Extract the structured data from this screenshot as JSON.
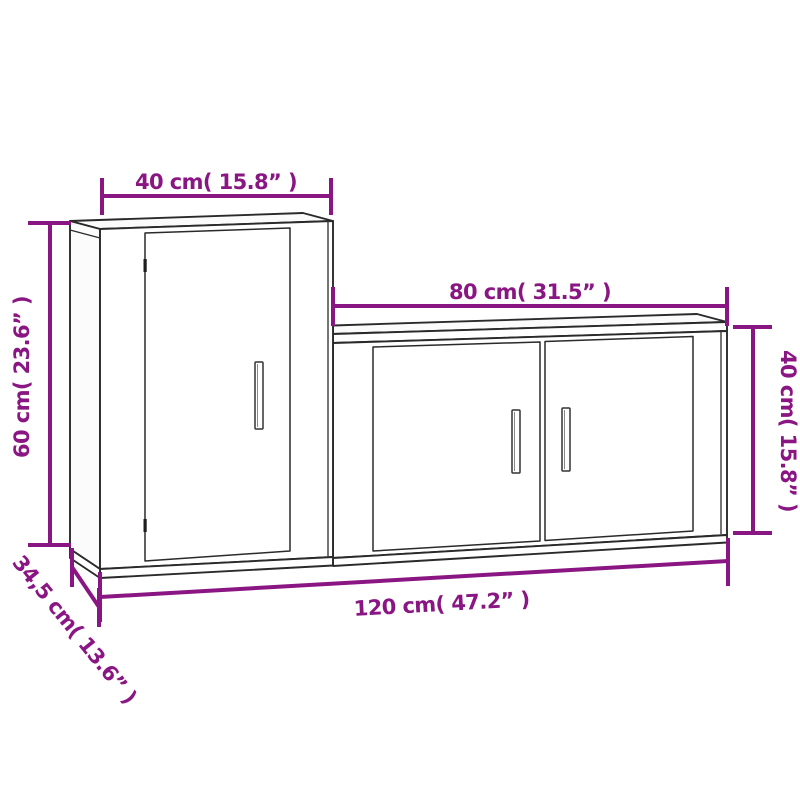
{
  "diagram": {
    "kind": "furniture-dimension-drawing",
    "background": "#ffffff"
  },
  "colors": {
    "dimension_accent": "#8a1683",
    "drawing_line": "#2a2a2a"
  },
  "furniture": {
    "items": [
      {
        "name": "tall-wall-cabinet",
        "doors": 1,
        "handles": 1
      },
      {
        "name": "wide-wall-cabinet",
        "doors": 2,
        "handles": 2
      }
    ]
  },
  "dimensions": {
    "tall_width": {
      "label": "40 cm( 15.8” )"
    },
    "low_width": {
      "label": "80 cm( 31.5” )"
    },
    "tall_height": {
      "label": "60 cm( 23.6” )"
    },
    "low_height": {
      "label": "40 cm( 15.8” )"
    },
    "total_width": {
      "label": "120 cm( 47.2” )"
    },
    "depth": {
      "label": "34,5 cm( 13.6” )"
    }
  }
}
